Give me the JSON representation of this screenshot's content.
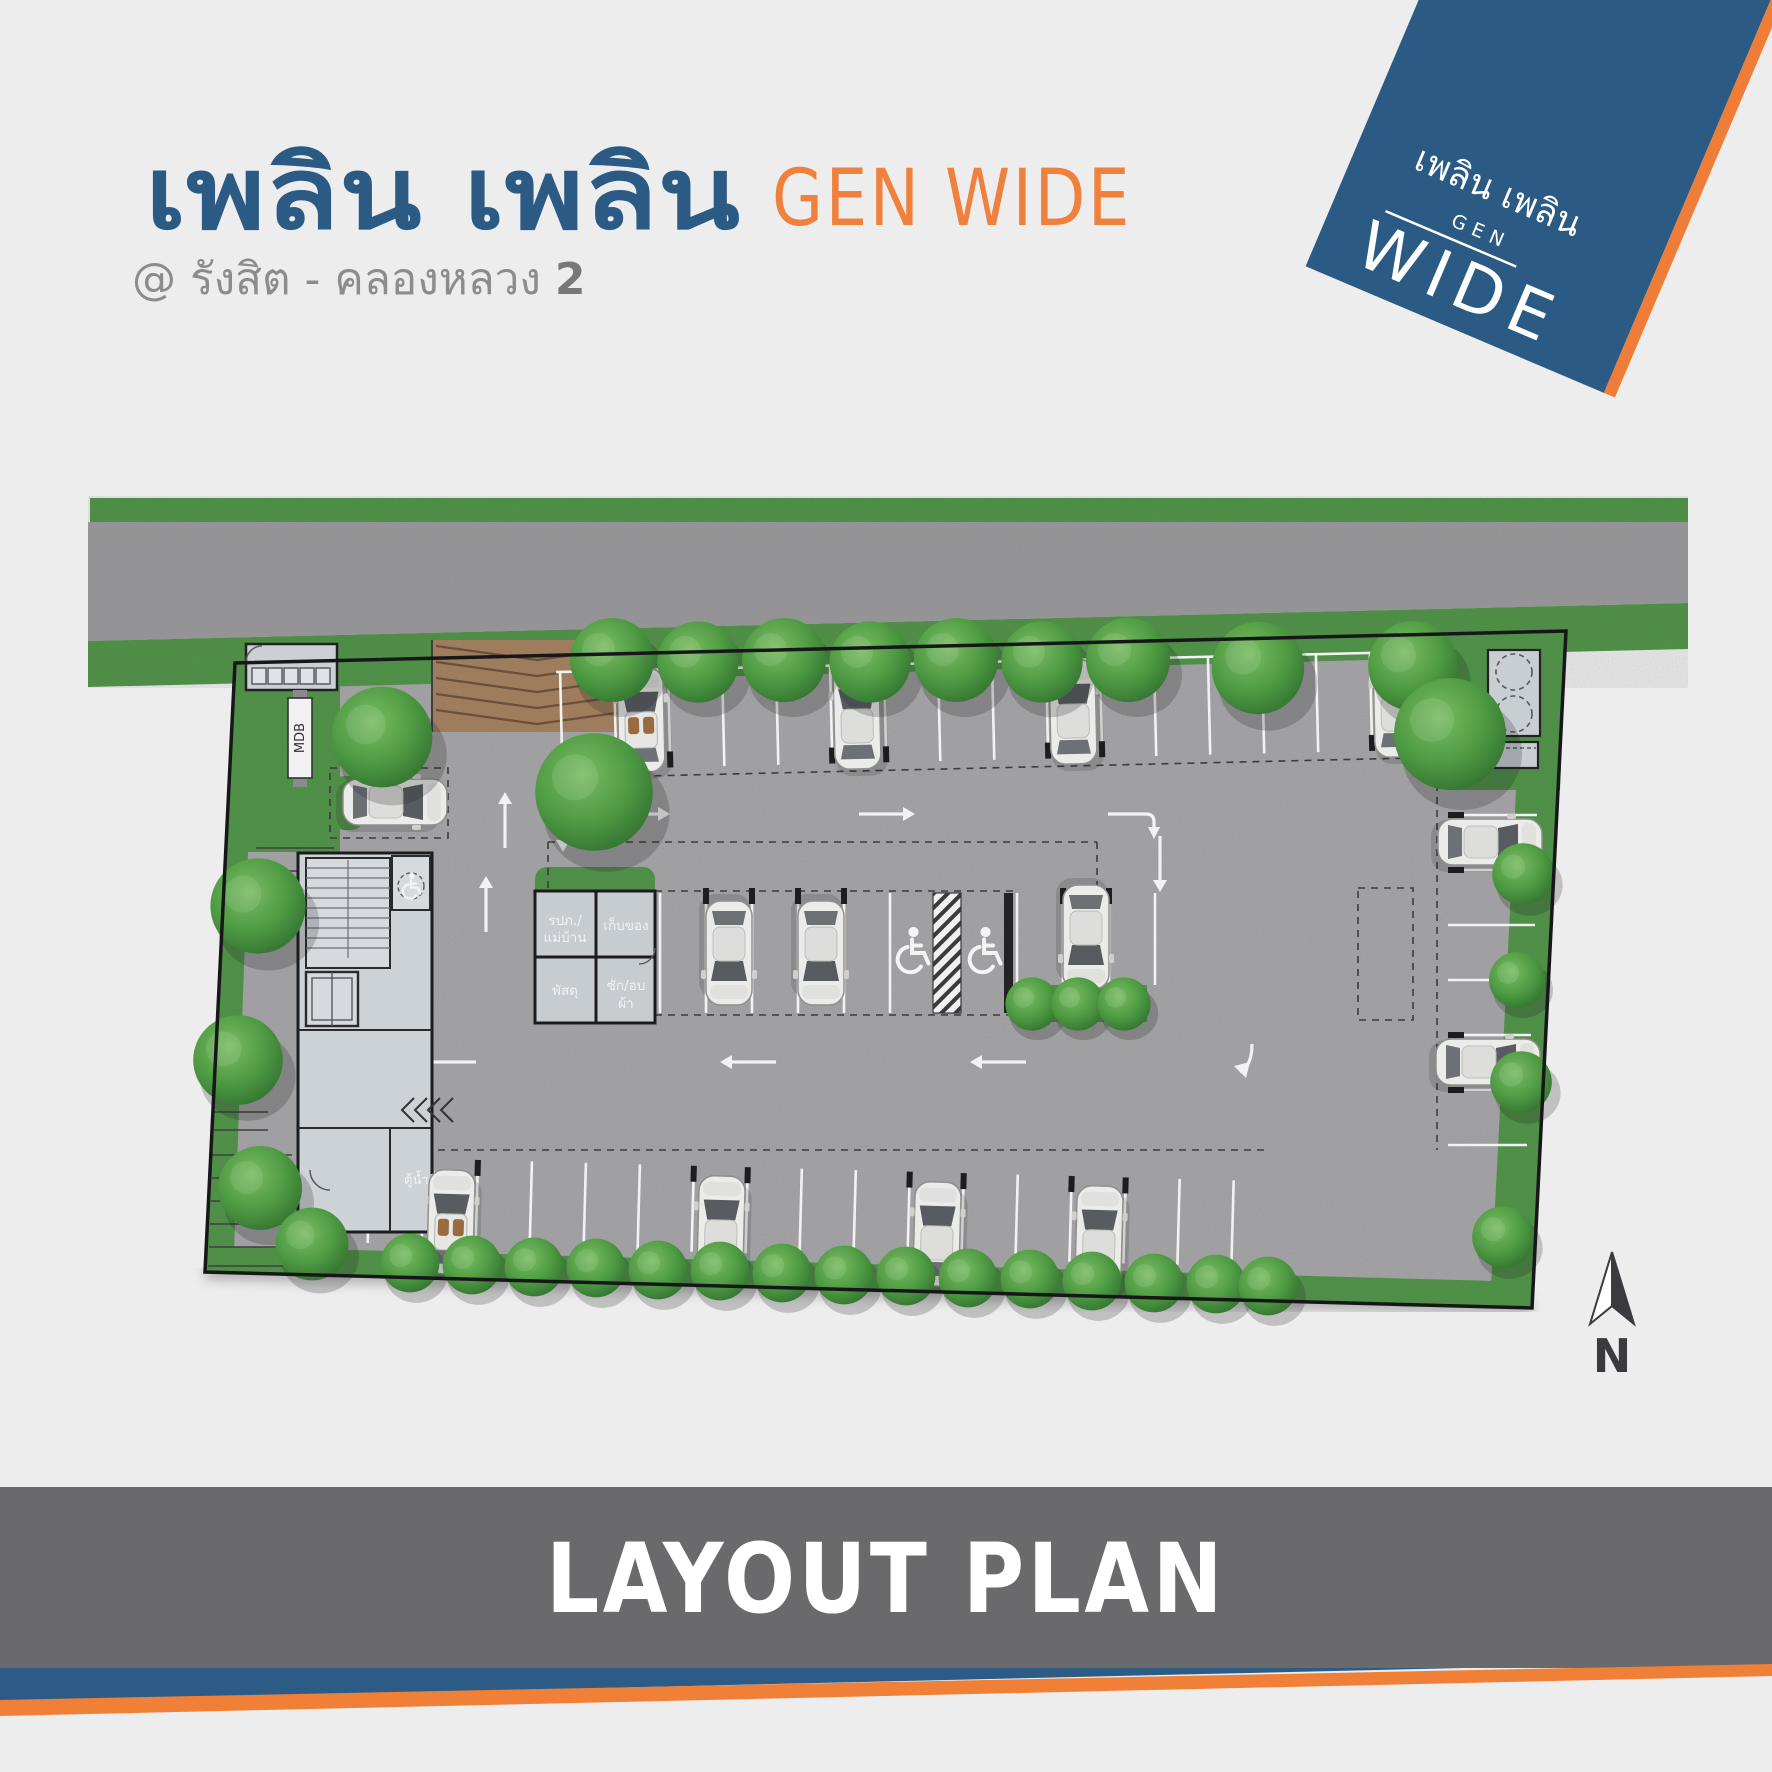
{
  "header": {
    "title_th": "เพลิน เพลิน",
    "title_en": "GEN WIDE",
    "subtitle_prefix": "@  รังสิต - คลองหลวง ",
    "subtitle_number": "2"
  },
  "logo": {
    "brand_th": "เพลิน เพลิน",
    "gen": "GEN",
    "wide": "WIDE"
  },
  "plan": {
    "labels": {
      "mdb_sign": "MDB",
      "water_dispenser": "ตู้น้ำดื่ม",
      "north": "N"
    },
    "rooms": {
      "security": {
        "line1": "รปภ./",
        "line2": "แม่บ้าน"
      },
      "storage": {
        "line1": "เก็บของ",
        "line2": ""
      },
      "parcel": {
        "line1": "พัสดุ",
        "line2": ""
      },
      "laundry": {
        "line1": "ซัก/อบ",
        "line2": "ผ้า"
      }
    }
  },
  "footer": {
    "caption": "LAYOUT PLAN"
  },
  "colors": {
    "brand_blue": "#2b5a84",
    "brand_orange": "#ef7d38",
    "banner_gray": "#6a696b",
    "subtitle_gray": "#8c8c8c",
    "grass": "#4d9444",
    "asphalt": "#9a999b",
    "pavement": "#a7a6a8",
    "driveway_brown": "#a5805c",
    "building_floor": "#cdd2d7"
  }
}
